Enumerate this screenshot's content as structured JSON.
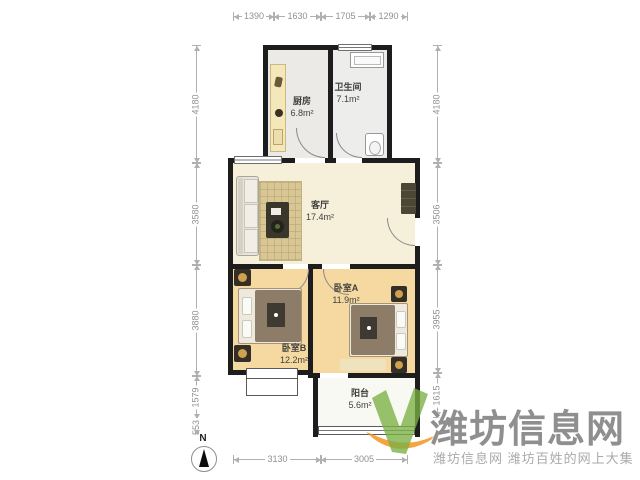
{
  "rooms": {
    "kitchen": {
      "name": "厨房",
      "area": "6.8m²"
    },
    "bathroom": {
      "name": "卫生间",
      "area": "7.1m²"
    },
    "living_room": {
      "name": "客厅",
      "area": "17.4m²"
    },
    "bedroom_a": {
      "name": "卧室A",
      "area": "11.9m²"
    },
    "bedroom_b": {
      "name": "卧室B",
      "area": "12.2m²"
    },
    "balcony": {
      "name": "阳台",
      "area": "5.6m²"
    }
  },
  "dimensions_mm": {
    "top": [
      "1390",
      "1630",
      "1705",
      "1290"
    ],
    "left": [
      "4180",
      "3580",
      "3880",
      "1579",
      "553"
    ],
    "right": [
      "4180",
      "3506",
      "3955",
      "1615"
    ],
    "bottom": [
      "3130",
      "3005"
    ]
  },
  "compass": {
    "north_label": "N"
  },
  "watermark": {
    "title": "潍坊信息网",
    "subtitle": "潍坊信息网 潍坊百姓的网上大集"
  },
  "colors": {
    "wall": "#1d1d1d",
    "living_floor": "#f6efd9",
    "bedroom_floor": "#f6d9a1",
    "kitchen_floor": "#ebeae6",
    "bathroom_floor": "#ededeb",
    "balcony_floor": "#f8f9f2",
    "watermark_green": "#7ab042",
    "watermark_orange": "#f1941f",
    "dimension_text": "#909090"
  }
}
